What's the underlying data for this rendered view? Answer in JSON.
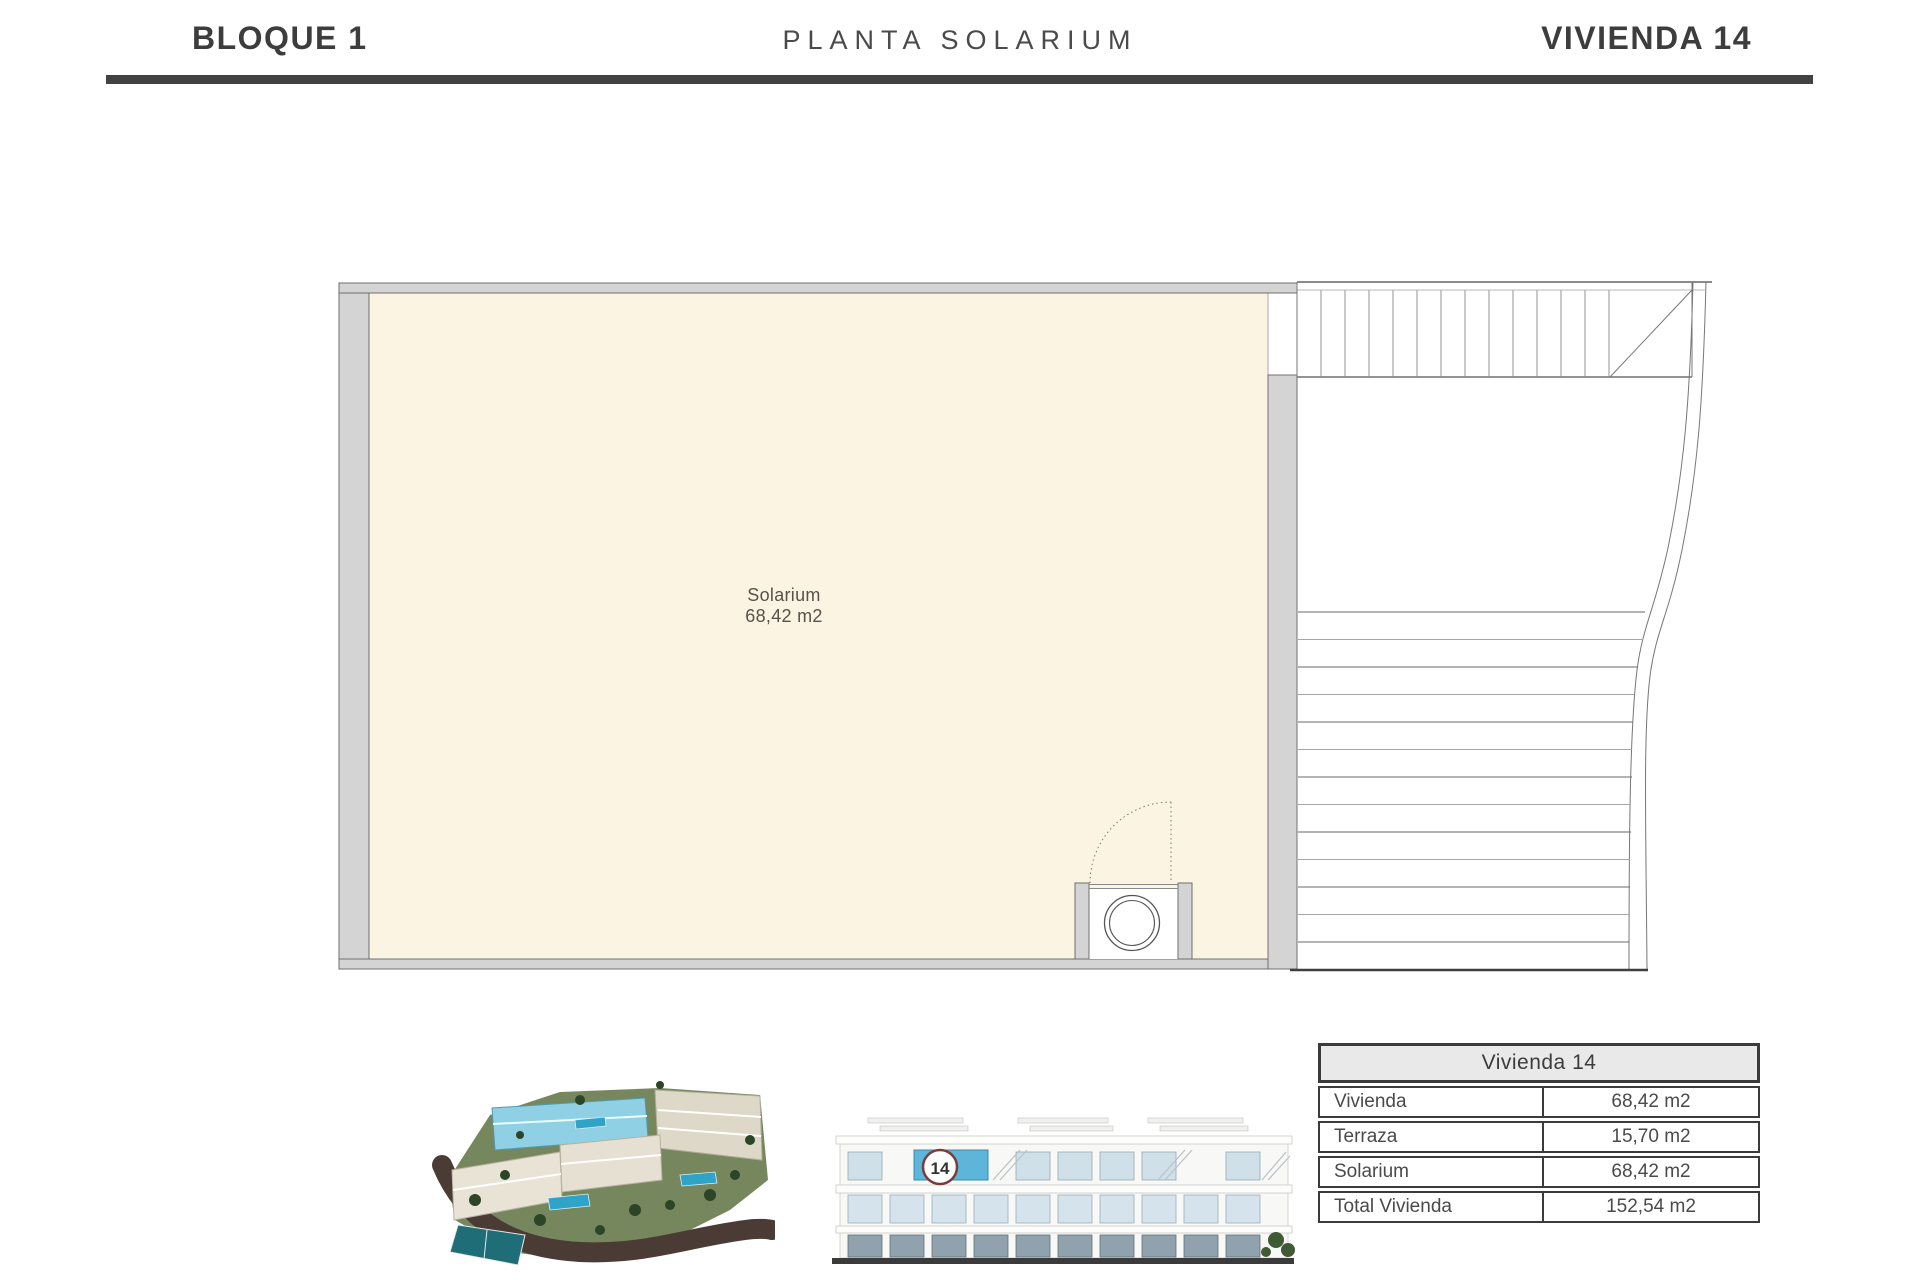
{
  "header": {
    "block": "BLOQUE 1",
    "plan_type": "PLANTA SOLARIUM",
    "unit": "VIVIENDA 14"
  },
  "floor_plan": {
    "room": {
      "name": "Solarium",
      "area": "68,42 m2"
    }
  },
  "elevation": {
    "unit_badge": "14"
  },
  "summary_table": {
    "title": "Vivienda 14",
    "rows": [
      {
        "label": "Vivienda",
        "value": "68,42 m2"
      },
      {
        "label": "Terraza",
        "value": "15,70 m2"
      },
      {
        "label": "Solarium",
        "value": "68,42 m2"
      },
      {
        "label": "Total Vivienda",
        "value": "152,54 m2"
      }
    ]
  },
  "colors": {
    "room_fill": "#FBF4E2",
    "wall_fill": "#D4D4D4",
    "rule_dark": "#424242",
    "highlight_blue": "#5DB5D9",
    "badge_ring": "#7D3C3C",
    "table_header_bg": "#E9E9E9"
  }
}
